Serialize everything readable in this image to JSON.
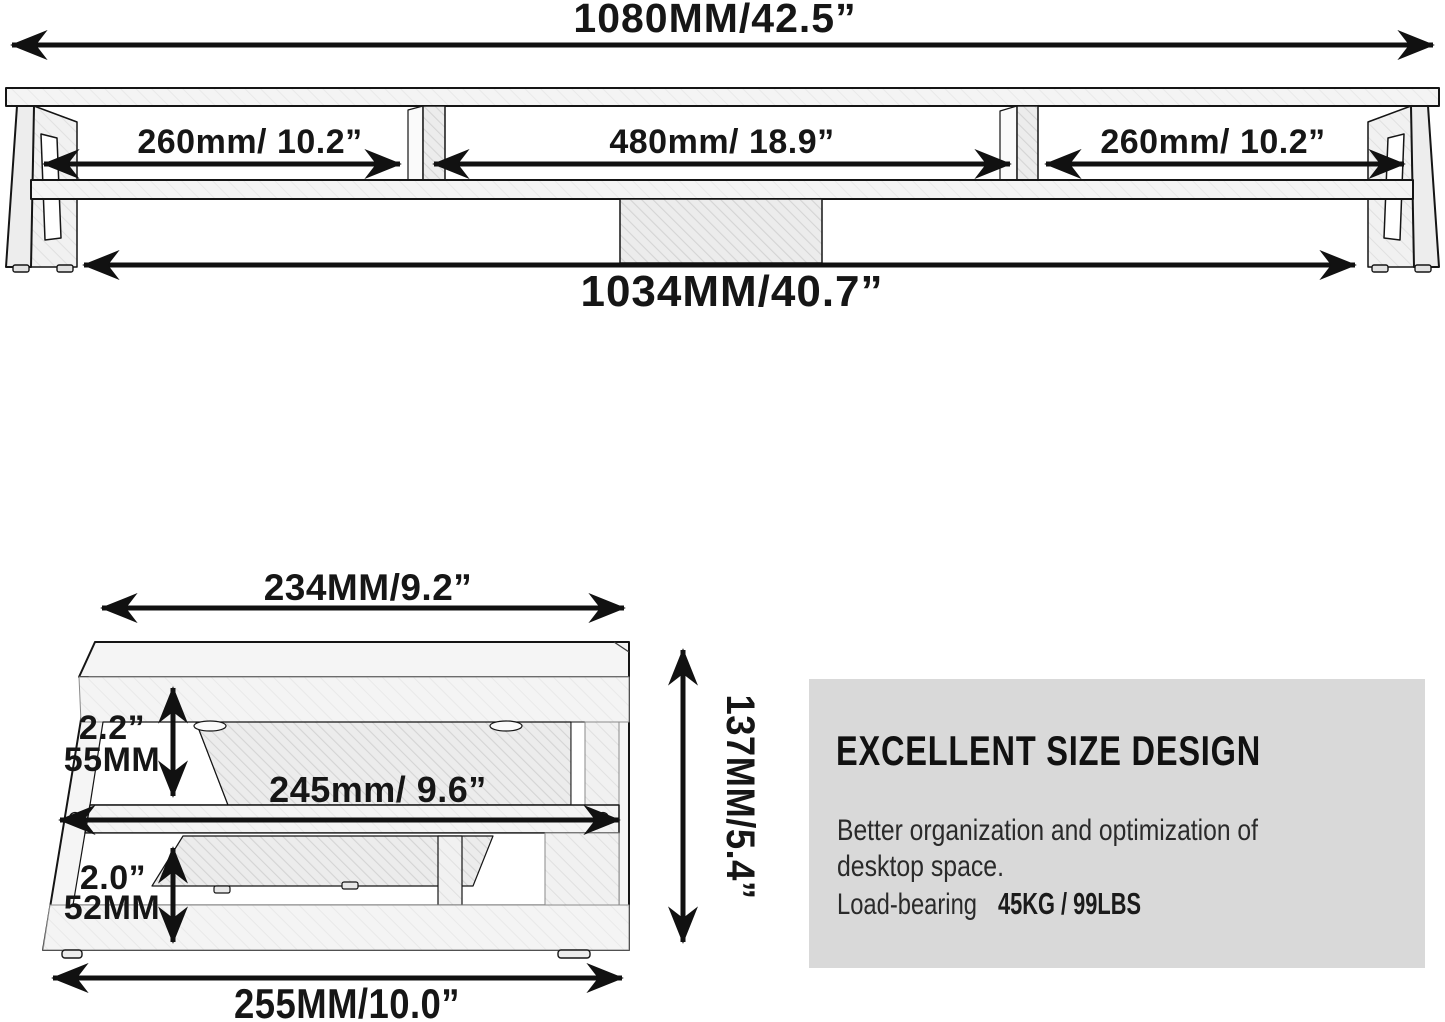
{
  "front_view": {
    "overall_width_label": "1080MM/42.5”",
    "section_labels": [
      "260mm/ 10.2”",
      "480mm/ 18.9”",
      "260mm/ 10.2”"
    ],
    "inner_width_label": "1034MM/40.7”"
  },
  "side_view": {
    "top_width_label": "234MM/9.2”",
    "upper_height_inch": "2.2”",
    "upper_height_mm": "55MM",
    "middle_depth_label": "245mm/ 9.6”",
    "lower_height_inch": "2.0”",
    "lower_height_mm": "52MM",
    "total_height_label": "137MM/5.4”",
    "bottom_width_label": "255MM/10.0”"
  },
  "info_box": {
    "title": "EXCELLENT SIZE DESIGN",
    "body_line1": "Better organization and optimization of",
    "body_line2": "desktop space.",
    "load_bearing_label": "Load-bearing",
    "load_bearing_value": "45KG / 99LBS"
  },
  "colors": {
    "background": "#ffffff",
    "line": "#151515",
    "panel_gray": "#d9d9d9",
    "fill_light": "#f3f3f3"
  }
}
